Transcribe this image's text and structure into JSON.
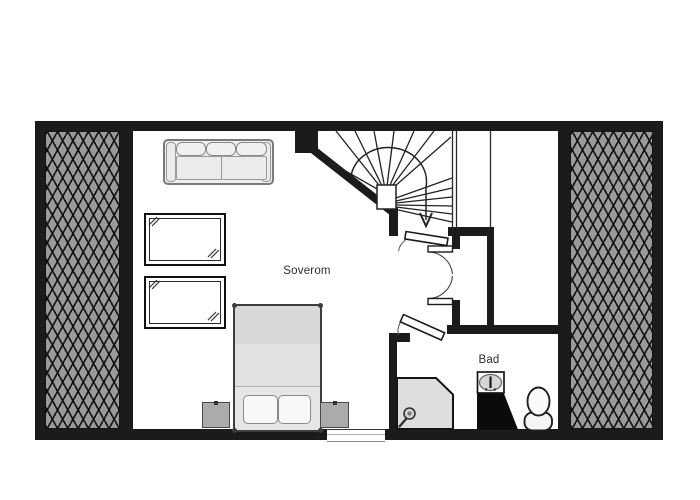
{
  "floor_plan": {
    "labels": {
      "bedroom": "Soverom",
      "bathroom": "Bad"
    },
    "colors": {
      "background": "#ffffff",
      "wall": "#1b1b1b",
      "roof_hatch_fill": "#9a9a9a",
      "roof_hatch_line": "#141414",
      "furniture_fill": "#e6e6e6",
      "fixture_dark": "#0b0b0b"
    },
    "objects": [
      {
        "name": "sofa"
      },
      {
        "name": "roof-window-upper"
      },
      {
        "name": "roof-window-lower"
      },
      {
        "name": "double-bed"
      },
      {
        "name": "nightstand-left"
      },
      {
        "name": "nightstand-right"
      },
      {
        "name": "winder-staircase-with-down-arrow"
      },
      {
        "name": "closet-double-doors"
      },
      {
        "name": "shower"
      },
      {
        "name": "washbasin"
      },
      {
        "name": "toilet"
      },
      {
        "name": "window-bottom-wall"
      },
      {
        "name": "roof-slope-hatch-left"
      },
      {
        "name": "roof-slope-hatch-right"
      }
    ]
  }
}
